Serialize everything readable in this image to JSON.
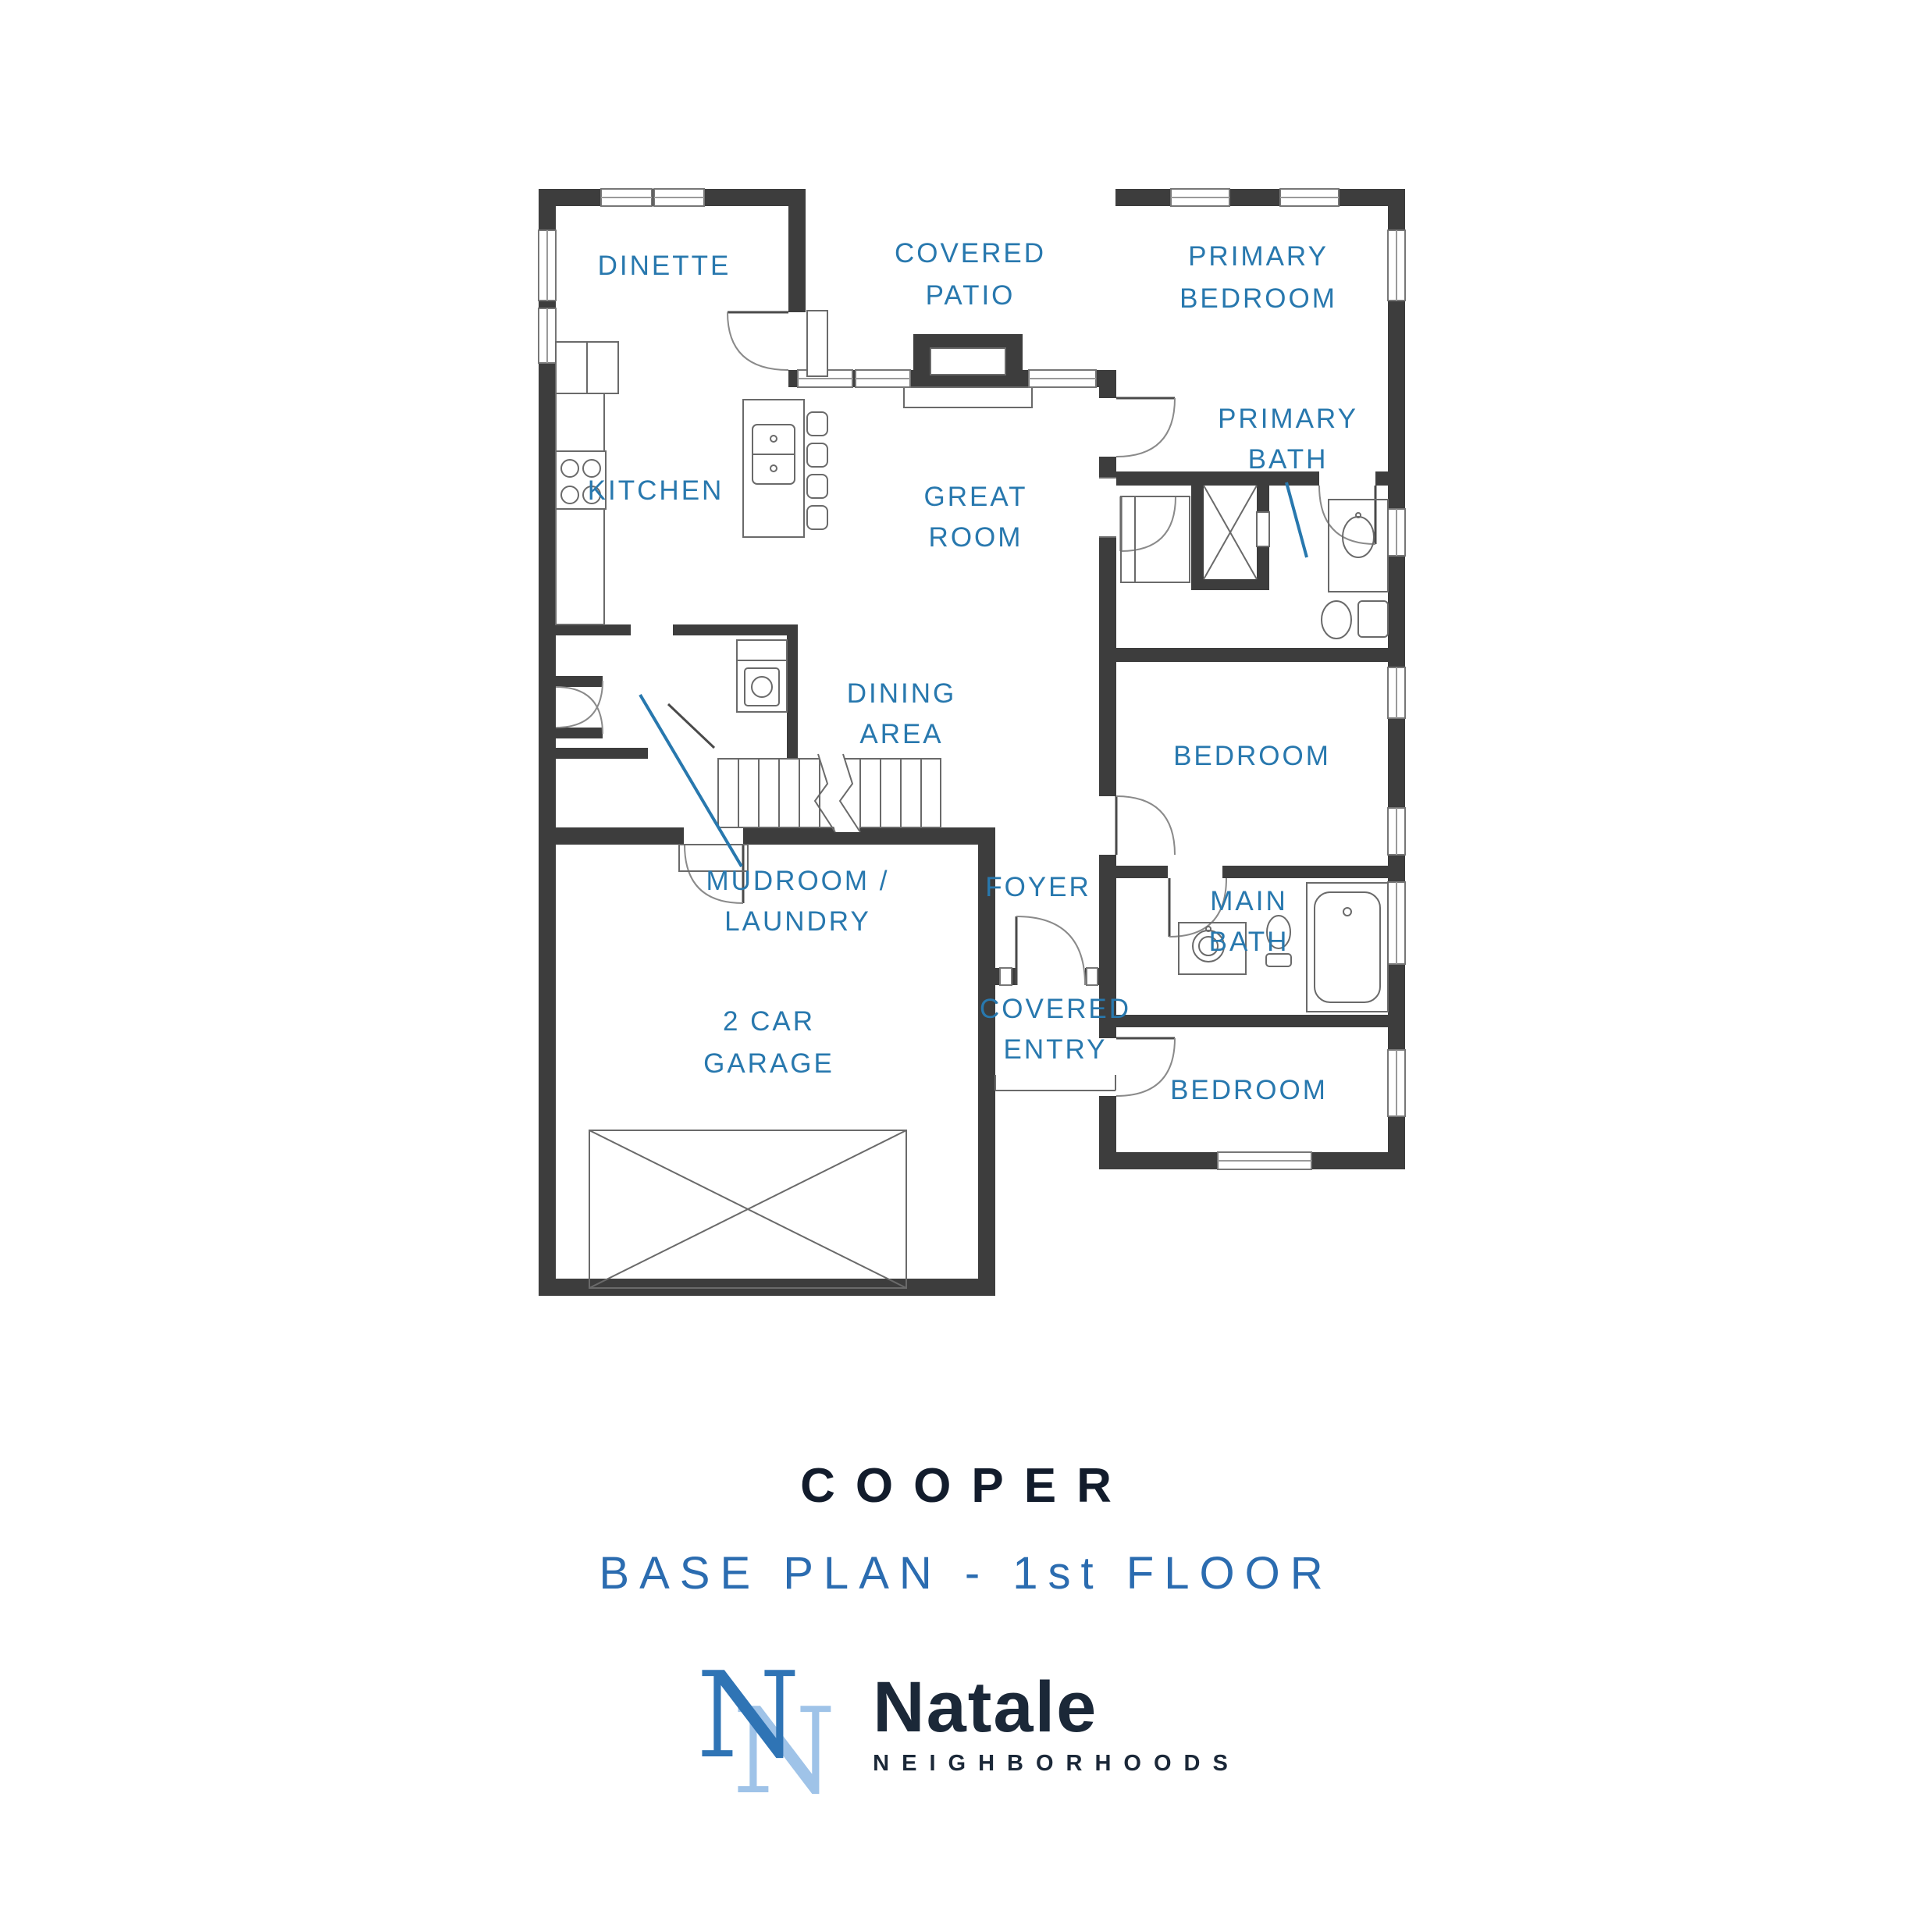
{
  "rooms": {
    "dinette": {
      "label": "DINETTE"
    },
    "covered_patio": {
      "l1": "COVERED",
      "l2": "PATIO"
    },
    "primary_bedroom": {
      "l1": "PRIMARY",
      "l2": "BEDROOM"
    },
    "primary_bath": {
      "l1": "PRIMARY",
      "l2": "BATH"
    },
    "kitchen": {
      "label": "KITCHEN"
    },
    "great_room": {
      "l1": "GREAT",
      "l2": "ROOM"
    },
    "dining_area": {
      "l1": "DINING",
      "l2": "AREA"
    },
    "mudroom": {
      "l1": "MUDROOM /",
      "l2": "LAUNDRY"
    },
    "foyer": {
      "label": "FOYER"
    },
    "bedroom_mid": {
      "label": "BEDROOM"
    },
    "main_bath": {
      "l1": "MAIN",
      "l2": "BATH"
    },
    "bedroom_bottom": {
      "label": "BEDROOM"
    },
    "garage": {
      "l1": "2 CAR",
      "l2": "GARAGE"
    },
    "covered_entry": {
      "l1": "COVERED",
      "l2": "ENTRY"
    }
  },
  "titleblock": {
    "plan_name": "COOPER",
    "plan_variant": "BASE PLAN - 1st FLOOR"
  },
  "logo": {
    "monogram_letter_front": "N",
    "monogram_letter_back": "N",
    "name": "Natale",
    "tagline": "NEIGHBORHOODS"
  },
  "colors": {
    "room_label_blue": "#2878ae",
    "wall_charcoal": "#3d3d3d",
    "plan_name_navy": "#121c2c",
    "plan_variant_blue": "#2b6cb0",
    "logo_dark_blue": "#2f74b5",
    "logo_light_blue": "#9fc3e8",
    "logo_text_navy": "#1b2838"
  }
}
